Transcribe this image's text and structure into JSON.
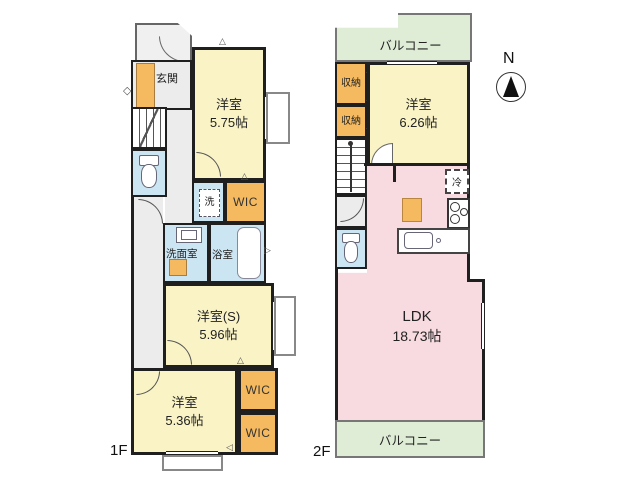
{
  "colors": {
    "wall": "#1f1f1f",
    "room_yellow": "#FAF3C6",
    "storage_orange": "#F5BA5F",
    "water_blue": "#CBE5F3",
    "ldk_pink": "#F8DBE1",
    "balcony_green": "#E0EDD6",
    "corridor_gray": "#ECECEC"
  },
  "compass": {
    "label": "N"
  },
  "floor1": {
    "label": "1F",
    "entrance": {
      "label": "玄関"
    },
    "room_575": {
      "name": "洋室",
      "size": "5.75帖"
    },
    "laundry": {
      "label": "洗"
    },
    "wic_upper": {
      "label": "WIC"
    },
    "washroom": {
      "label": "洗面室"
    },
    "bathroom": {
      "label": "浴室"
    },
    "room_s": {
      "name": "洋室(S)",
      "size": "5.96帖"
    },
    "room_536": {
      "name": "洋室",
      "size": "5.36帖"
    },
    "wic_mid": {
      "label": "WIC"
    },
    "wic_lower": {
      "label": "WIC"
    }
  },
  "floor2": {
    "label": "2F",
    "balcony_top": {
      "label": "バルコニー"
    },
    "storage_upper": {
      "label": "収納"
    },
    "storage_lower": {
      "label": "収納"
    },
    "room_626": {
      "name": "洋室",
      "size": "6.26帖"
    },
    "fridge": {
      "label": "冷"
    },
    "ldk": {
      "name": "LDK",
      "size": "18.73帖"
    },
    "balcony_bottom": {
      "label": "バルコニー"
    }
  },
  "marks": {
    "tri_left": "◁",
    "tri_up": "△",
    "tri_right": "▷",
    "diamond": "◇"
  }
}
